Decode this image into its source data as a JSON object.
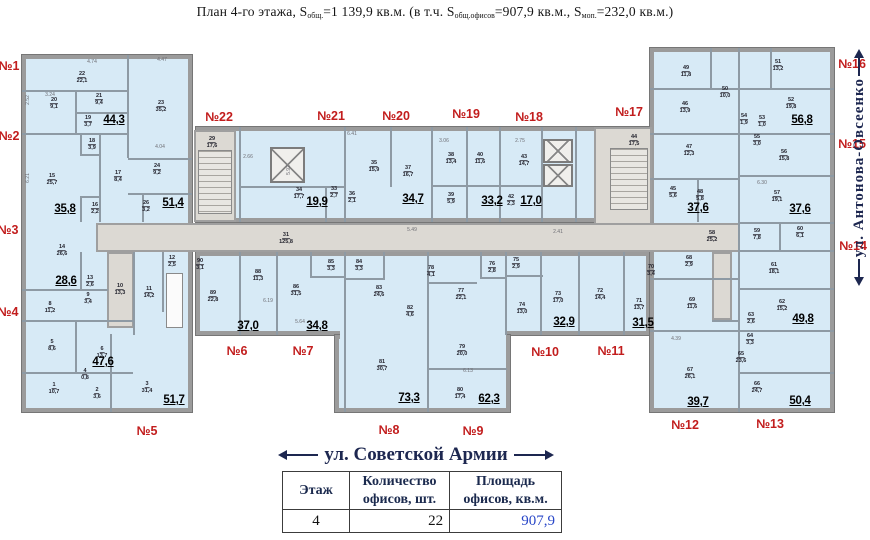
{
  "title": {
    "p1": "План 4-го этажа, S",
    "s1": "общ.",
    "p2": "=1 139,9 кв.м. (в т.ч. S",
    "s2": "общ.офисов",
    "p3": "=907,9 кв.м., S",
    "s3": "моп.",
    "p4": "=232,0 кв.м.)"
  },
  "streets": {
    "bottom": "ул. Советской Армии",
    "right": "ул. Антонова-Овсеенко"
  },
  "table": {
    "h1": "Этаж",
    "h2": "Количество\nофисов, шт.",
    "h3": "Площадь\nофисов, кв.м.",
    "floor": "4",
    "count": "22",
    "area": "907,9"
  },
  "colors": {
    "room_fill": "#d7eaf6",
    "corridor_fill": "#dcd9d3",
    "wall": "#9b9b9b",
    "apartment_label": "#c21d1d",
    "street_text": "#1d2750",
    "area_value_blue": "#2947c8"
  },
  "plan": {
    "blocks": [
      {
        "x": 22,
        "y": 55,
        "w": 170,
        "h": 357,
        "f": "blue",
        "name": "left-wing"
      },
      {
        "x": 196,
        "y": 127,
        "w": 454,
        "h": 95,
        "f": "blue",
        "name": "central-top-rooms"
      },
      {
        "x": 196,
        "y": 252,
        "w": 454,
        "h": 83,
        "f": "blue",
        "name": "central-bottom-rooms"
      },
      {
        "x": 335,
        "y": 335,
        "w": 175,
        "h": 77,
        "f": "blue",
        "name": "center-lower-block"
      },
      {
        "x": 650,
        "y": 48,
        "w": 184,
        "h": 364,
        "f": "blue",
        "name": "right-wing"
      },
      {
        "x": 194,
        "y": 130,
        "w": 42,
        "h": 92,
        "f": "grey",
        "name": "stairwell-left-zone"
      },
      {
        "x": 594,
        "y": 127,
        "w": 58,
        "h": 125,
        "f": "grey",
        "name": "stairwell-right-zone"
      },
      {
        "x": 96,
        "y": 223,
        "w": 644,
        "h": 29,
        "f": "grey",
        "name": "corridor"
      },
      {
        "x": 107,
        "y": 252,
        "w": 27,
        "h": 76,
        "f": "grey",
        "name": "utility-room"
      },
      {
        "x": 712,
        "y": 252,
        "w": 20,
        "h": 68,
        "f": "grey",
        "name": "right-wing-corridor"
      },
      {
        "x": 340,
        "y": 331,
        "w": 166,
        "h": 8,
        "f": "patch",
        "name": "block-join"
      }
    ],
    "walls": [
      [
        127,
        55,
        2,
        103
      ],
      [
        22,
        90,
        106,
        2
      ],
      [
        75,
        90,
        2,
        44
      ],
      [
        75,
        112,
        53,
        2
      ],
      [
        22,
        133,
        106,
        2
      ],
      [
        99,
        133,
        2,
        89
      ],
      [
        80,
        133,
        2,
        22
      ],
      [
        80,
        154,
        20,
        2
      ],
      [
        80,
        196,
        2,
        26
      ],
      [
        80,
        196,
        20,
        2
      ],
      [
        128,
        158,
        64,
        2
      ],
      [
        128,
        193,
        64,
        2
      ],
      [
        142,
        193,
        2,
        29
      ],
      [
        22,
        289,
        86,
        2
      ],
      [
        80,
        252,
        2,
        38
      ],
      [
        22,
        320,
        111,
        2
      ],
      [
        75,
        320,
        2,
        52
      ],
      [
        22,
        372,
        111,
        2
      ],
      [
        110,
        372,
        2,
        40
      ],
      [
        133,
        252,
        2,
        83
      ],
      [
        162,
        252,
        2,
        60
      ],
      [
        110,
        334,
        2,
        38
      ],
      [
        239,
        127,
        2,
        95
      ],
      [
        344,
        127,
        2,
        95
      ],
      [
        431,
        127,
        2,
        95
      ],
      [
        466,
        127,
        2,
        95
      ],
      [
        499,
        127,
        2,
        95
      ],
      [
        541,
        127,
        2,
        95
      ],
      [
        575,
        127,
        2,
        95
      ],
      [
        390,
        127,
        2,
        60
      ],
      [
        240,
        186,
        104,
        2
      ],
      [
        432,
        185,
        110,
        2
      ],
      [
        325,
        186,
        2,
        36
      ],
      [
        239,
        252,
        2,
        83
      ],
      [
        276,
        252,
        2,
        83
      ],
      [
        344,
        252,
        2,
        160
      ],
      [
        427,
        252,
        2,
        160
      ],
      [
        505,
        252,
        2,
        83
      ],
      [
        540,
        252,
        2,
        83
      ],
      [
        578,
        252,
        2,
        83
      ],
      [
        623,
        252,
        2,
        83
      ],
      [
        310,
        252,
        2,
        26
      ],
      [
        310,
        276,
        36,
        2
      ],
      [
        383,
        252,
        2,
        26
      ],
      [
        345,
        278,
        40,
        2
      ],
      [
        427,
        282,
        50,
        2
      ],
      [
        480,
        252,
        2,
        26
      ],
      [
        480,
        277,
        27,
        2
      ],
      [
        505,
        275,
        38,
        2
      ],
      [
        427,
        368,
        80,
        2
      ],
      [
        738,
        48,
        2,
        364
      ],
      [
        650,
        88,
        88,
        2
      ],
      [
        740,
        88,
        94,
        2
      ],
      [
        650,
        133,
        88,
        2
      ],
      [
        740,
        133,
        94,
        2
      ],
      [
        650,
        178,
        88,
        2
      ],
      [
        697,
        178,
        2,
        44
      ],
      [
        740,
        175,
        94,
        2
      ],
      [
        740,
        222,
        94,
        2
      ],
      [
        740,
        250,
        94,
        2
      ],
      [
        779,
        222,
        2,
        30
      ],
      [
        740,
        288,
        94,
        2
      ],
      [
        740,
        330,
        94,
        2
      ],
      [
        740,
        372,
        94,
        2
      ],
      [
        650,
        278,
        88,
        2
      ],
      [
        650,
        330,
        88,
        2
      ],
      [
        712,
        320,
        28,
        2
      ],
      [
        710,
        48,
        2,
        40
      ],
      [
        770,
        48,
        2,
        40
      ]
    ],
    "stairs": [
      [
        198,
        150,
        34,
        64
      ],
      [
        610,
        148,
        38,
        62
      ]
    ],
    "elevators": [
      [
        270,
        147,
        35,
        36
      ],
      [
        543,
        139,
        30,
        24
      ],
      [
        543,
        164,
        30,
        23
      ]
    ],
    "shafts": [
      [
        166,
        273,
        17,
        55
      ]
    ],
    "rooms": [
      [
        "22",
        "22,1",
        82,
        78
      ],
      [
        "20",
        "9,1",
        54,
        104
      ],
      [
        "21",
        "9,4",
        99,
        100
      ],
      [
        "19",
        "3,7",
        88,
        122
      ],
      [
        "23",
        "35,2",
        161,
        107
      ],
      [
        "15",
        "25,7",
        52,
        180
      ],
      [
        "18",
        "3,9",
        92,
        145
      ],
      [
        "17",
        "8,4",
        118,
        177
      ],
      [
        "24",
        "9,2",
        157,
        170
      ],
      [
        "26",
        "3,2",
        146,
        207
      ],
      [
        "16",
        "2,2",
        95,
        209
      ],
      [
        "29",
        "17,6",
        212,
        143
      ],
      [
        "14",
        "26,6",
        62,
        251
      ],
      [
        "13",
        "2,6",
        90,
        282
      ],
      [
        "9",
        "3,4",
        88,
        299
      ],
      [
        "8",
        "11,2",
        50,
        308
      ],
      [
        "10",
        "13,3",
        120,
        290
      ],
      [
        "11",
        "14,2",
        149,
        293
      ],
      [
        "12",
        "2,5",
        172,
        262
      ],
      [
        "5",
        "8,6",
        52,
        346
      ],
      [
        "6",
        "13,7",
        102,
        353
      ],
      [
        "4",
        "0,8",
        85,
        375
      ],
      [
        "1",
        "10,7",
        54,
        389
      ],
      [
        "2",
        "3,6",
        97,
        394
      ],
      [
        "3",
        "31,4",
        147,
        388
      ],
      [
        "34",
        "17,7",
        299,
        194
      ],
      [
        "33",
        "2,7",
        334,
        193
      ],
      [
        "36",
        "2,1",
        352,
        198
      ],
      [
        "35",
        "15,9",
        374,
        167
      ],
      [
        "37",
        "16,7",
        408,
        172
      ],
      [
        "38",
        "13,4",
        451,
        159
      ],
      [
        "40",
        "11,6",
        480,
        159
      ],
      [
        "39",
        "5,9",
        451,
        199
      ],
      [
        "43",
        "14,7",
        524,
        161
      ],
      [
        "42",
        "2,3",
        511,
        201
      ],
      [
        "44",
        "17,5",
        634,
        141
      ],
      [
        "31",
        "125,8",
        286,
        239
      ],
      [
        "90",
        "3,1",
        200,
        265
      ],
      [
        "89",
        "22,8",
        213,
        297
      ],
      [
        "88",
        "11,3",
        258,
        276
      ],
      [
        "86",
        "31,5",
        296,
        291
      ],
      [
        "85",
        "3,3",
        331,
        266
      ],
      [
        "84",
        "3,3",
        359,
        266
      ],
      [
        "83",
        "24,6",
        379,
        292
      ],
      [
        "82",
        "4,6",
        410,
        312
      ],
      [
        "78",
        "4,1",
        431,
        272
      ],
      [
        "81",
        "30,7",
        382,
        366
      ],
      [
        "79",
        "20,0",
        462,
        351
      ],
      [
        "80",
        "17,4",
        460,
        394
      ],
      [
        "77",
        "22,1",
        461,
        295
      ],
      [
        "76",
        "2,8",
        492,
        268
      ],
      [
        "75",
        "2,9",
        516,
        264
      ],
      [
        "74",
        "13,0",
        522,
        309
      ],
      [
        "73",
        "17,0",
        558,
        298
      ],
      [
        "72",
        "14,4",
        600,
        295
      ],
      [
        "71",
        "13,7",
        639,
        305
      ],
      [
        "49",
        "11,8",
        686,
        72
      ],
      [
        "50",
        "10,0",
        725,
        93
      ],
      [
        "46",
        "13,9",
        685,
        108
      ],
      [
        "47",
        "12,3",
        689,
        151
      ],
      [
        "45",
        "5,6",
        673,
        193
      ],
      [
        "48",
        "5,8",
        700,
        196
      ],
      [
        "51",
        "13,2",
        778,
        66
      ],
      [
        "52",
        "19,8",
        791,
        104
      ],
      [
        "54",
        "1,9",
        744,
        120
      ],
      [
        "53",
        "1,0",
        762,
        122
      ],
      [
        "55",
        "3,0",
        757,
        141
      ],
      [
        "56",
        "15,8",
        784,
        156
      ],
      [
        "57",
        "19,1",
        777,
        197
      ],
      [
        "58",
        "25,2",
        712,
        237
      ],
      [
        "59",
        "7,8",
        757,
        235
      ],
      [
        "60",
        "6,1",
        800,
        233
      ],
      [
        "61",
        "18,1",
        774,
        269
      ],
      [
        "62",
        "15,2",
        782,
        306
      ],
      [
        "63",
        "2,6",
        751,
        319
      ],
      [
        "64",
        "3,3",
        750,
        340
      ],
      [
        "65",
        "23,6",
        741,
        358
      ],
      [
        "66",
        "24,7",
        757,
        388
      ],
      [
        "68",
        "2,9",
        689,
        262
      ],
      [
        "70",
        "3,4",
        651,
        271
      ],
      [
        "69",
        "11,6",
        692,
        304
      ],
      [
        "67",
        "26,1",
        690,
        374
      ]
    ],
    "totals": [
      [
        "44,3",
        114,
        120
      ],
      [
        "35,8",
        65,
        209
      ],
      [
        "51,4",
        173,
        203
      ],
      [
        "28,6",
        66,
        281
      ],
      [
        "47,6",
        103,
        362
      ],
      [
        "51,7",
        174,
        400
      ],
      [
        "19,9",
        317,
        202
      ],
      [
        "34,7",
        413,
        199
      ],
      [
        "33,2",
        492,
        201
      ],
      [
        "17,0",
        531,
        201
      ],
      [
        "37,0",
        248,
        326
      ],
      [
        "34,8",
        317,
        326
      ],
      [
        "73,3",
        409,
        398
      ],
      [
        "62,3",
        489,
        399
      ],
      [
        "32,9",
        564,
        322
      ],
      [
        "31,5",
        643,
        323
      ],
      [
        "37,6",
        698,
        208
      ],
      [
        "56,8",
        802,
        120
      ],
      [
        "37,6",
        800,
        209
      ],
      [
        "49,8",
        803,
        319
      ],
      [
        "39,7",
        698,
        402
      ],
      [
        "50,4",
        800,
        401
      ]
    ],
    "apartments": [
      [
        "№1",
        9,
        66
      ],
      [
        "№2",
        9,
        136
      ],
      [
        "№3",
        8,
        230
      ],
      [
        "№4",
        8,
        312
      ],
      [
        "№5",
        147,
        431
      ],
      [
        "№6",
        237,
        351
      ],
      [
        "№7",
        303,
        351
      ],
      [
        "№8",
        389,
        430
      ],
      [
        "№9",
        473,
        431
      ],
      [
        "№10",
        545,
        352
      ],
      [
        "№11",
        611,
        351
      ],
      [
        "№12",
        685,
        425
      ],
      [
        "№13",
        770,
        424
      ],
      [
        "№14",
        853,
        246
      ],
      [
        "№15",
        852,
        144
      ],
      [
        "№16",
        852,
        64
      ],
      [
        "№17",
        629,
        112
      ],
      [
        "№18",
        529,
        117
      ],
      [
        "№19",
        466,
        114
      ],
      [
        "№20",
        396,
        116
      ],
      [
        "№21",
        331,
        116
      ],
      [
        "№22",
        219,
        117
      ]
    ],
    "dims": [
      [
        "4.74",
        92,
        62,
        0
      ],
      [
        "4.47",
        162,
        60,
        0
      ],
      [
        "3.24",
        50,
        95,
        0
      ],
      [
        "2.52",
        28,
        100,
        1
      ],
      [
        "6.21",
        28,
        178,
        1
      ],
      [
        "4.04",
        160,
        147,
        0
      ],
      [
        "2.66",
        248,
        157,
        0
      ],
      [
        "6.41",
        352,
        134,
        0
      ],
      [
        "3.06",
        444,
        141,
        0
      ],
      [
        "2.75",
        520,
        141,
        0
      ],
      [
        "5.92",
        289,
        170,
        1
      ],
      [
        "5.49",
        412,
        230,
        0
      ],
      [
        "2.41",
        558,
        232,
        0
      ],
      [
        "6.19",
        268,
        301,
        0
      ],
      [
        "5.64",
        300,
        322,
        0
      ],
      [
        "6.13",
        468,
        371,
        0
      ],
      [
        "6.30",
        762,
        183,
        0
      ],
      [
        "4.39",
        676,
        339,
        0
      ]
    ]
  }
}
